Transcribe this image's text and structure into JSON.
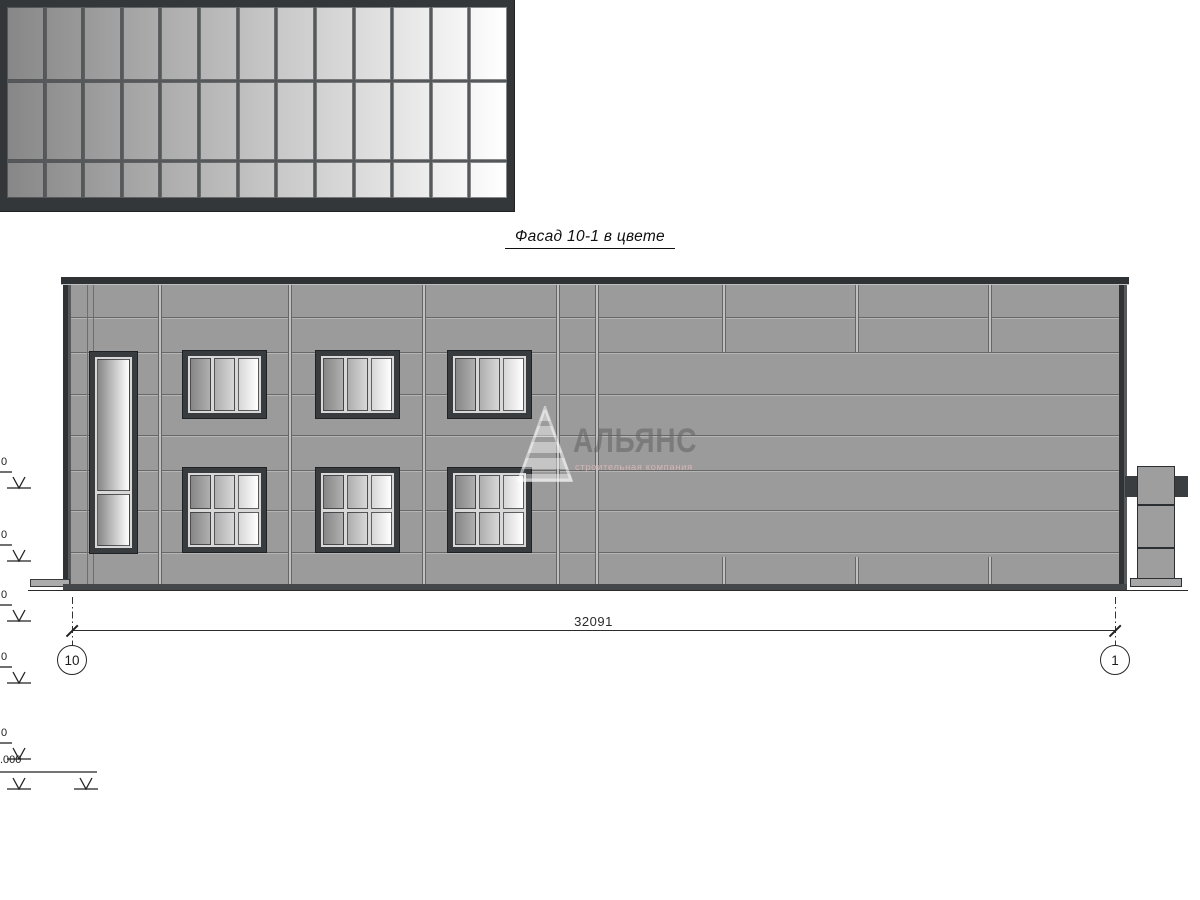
{
  "title": "Фасад 10-1 в цвете",
  "watermark": {
    "name": "АЛЬЯНС",
    "tagline": "строительная компания"
  },
  "dimension_label": "32091",
  "axis_left": "10",
  "axis_right": "1",
  "elevations": {
    "left": [
      {
        "label": "0",
        "bar_y": 277
      },
      {
        "label": "0",
        "bar_y": 350
      },
      {
        "label": "0",
        "bar_y": 410
      },
      {
        "label": "0",
        "bar_y": 472
      },
      {
        "label": "0",
        "bar_y": 548
      },
      {
        "label": ".000",
        "bar_y": 578,
        "type": "double"
      }
    ],
    "right": [
      {
        "label": "+",
        "bar_y": 277
      },
      {
        "label": "+",
        "bar_y": 350
      },
      {
        "label": "+",
        "bar_y": 465
      },
      {
        "label": "+",
        "bar_y": 545
      },
      {
        "label": "0",
        "bar_y": 578
      }
    ]
  },
  "facade": {
    "curtain_wall": {
      "columns": 13,
      "rows": 3
    },
    "windows_upper": {
      "count": 3,
      "cols": 3,
      "rows": 1
    },
    "windows_lower": {
      "count": 3,
      "cols": 3,
      "rows": 2
    },
    "window_tall": {
      "cols": 1,
      "rows": 2
    },
    "colors": {
      "wall": "#9b9b9b",
      "frame": "#383c3f",
      "glass_dark_level": 135,
      "glass_light_level": 255,
      "joint": "#6d6d6d"
    }
  }
}
